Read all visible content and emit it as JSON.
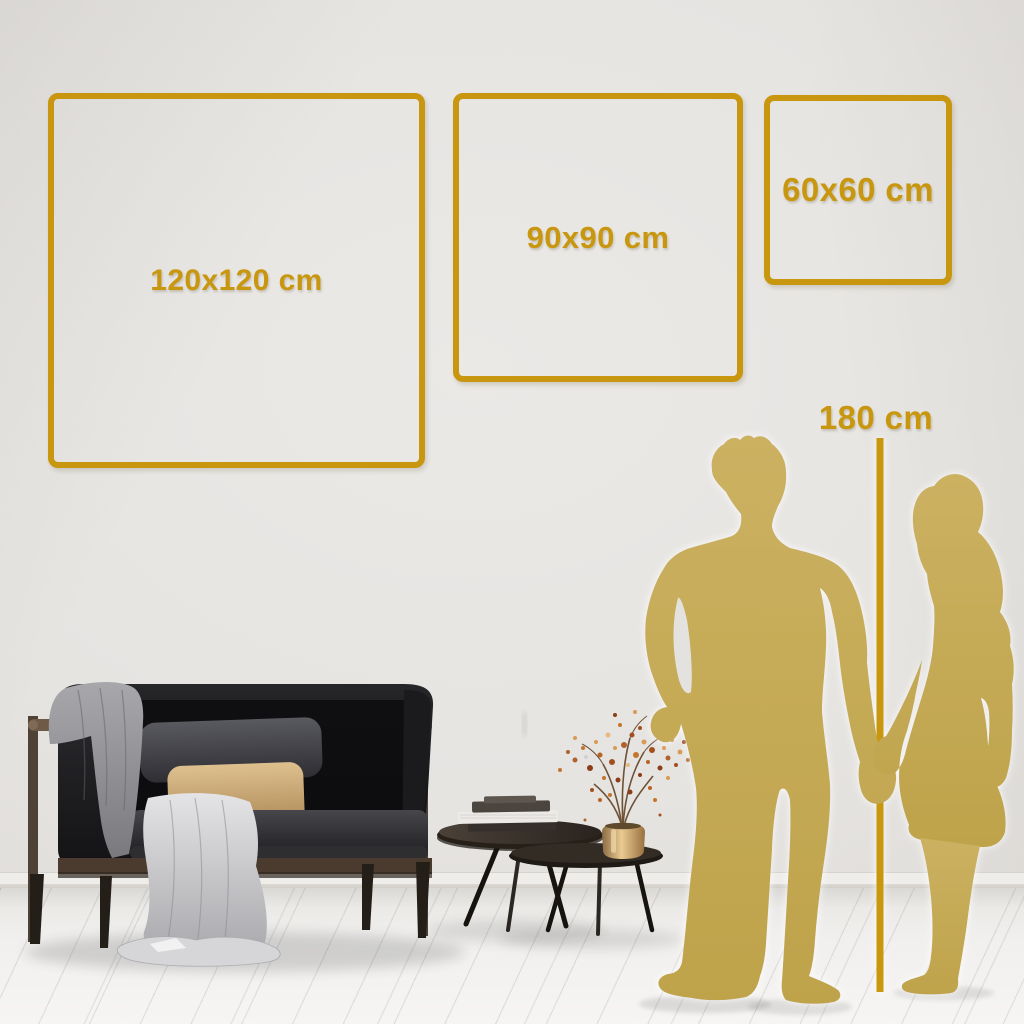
{
  "size_frames": [
    {
      "label": "120x120 cm"
    },
    {
      "label": "90x90 cm"
    },
    {
      "label": "60x60 cm"
    }
  ],
  "height_marker": {
    "label": "180 cm"
  },
  "colors": {
    "accent_gold": "#C8970F",
    "silhouette_gold": "#C5AA53",
    "wall": "#E6E4E1",
    "floor": "#F2F1EF",
    "sofa_dark": "#1A1A1C",
    "wood_brown": "#5C4A3A",
    "pillow_tan": "#D2B07E",
    "blanket_gray": "#97979B",
    "vase_brass": "#C79A5C",
    "blossom_rust": "#B0612F"
  }
}
